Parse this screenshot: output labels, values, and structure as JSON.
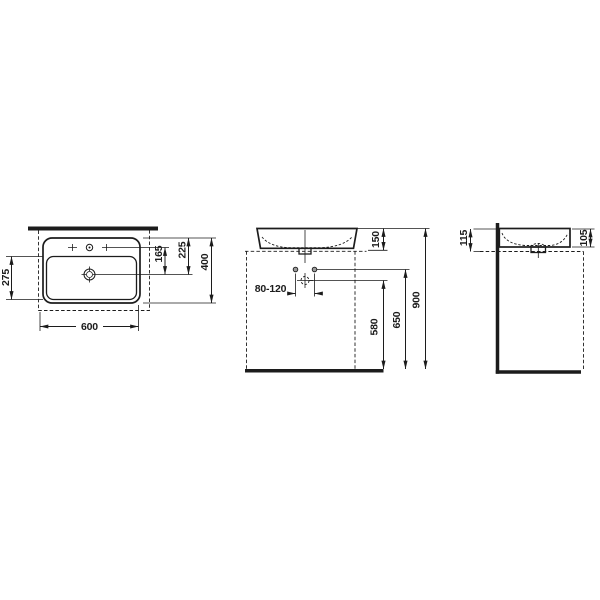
{
  "colors": {
    "ink": "#1c1c1c",
    "background": "#ffffff",
    "fixing_hole_fill": "#9a9a9a"
  },
  "dimensions": {
    "top_view": {
      "width": "600",
      "depth": "400",
      "bowl_depth": "275",
      "rear_edge_to_drain": "225",
      "tap_to_drain": "165"
    },
    "front_view": {
      "basin_height": "150",
      "tap_hole_spacing": "80-120",
      "drain_connection_height": "580",
      "fixing_holes_height": "650",
      "rim_height": "900"
    },
    "side_view": {
      "wall_mount_height": "115",
      "front_edge_height": "105"
    }
  }
}
